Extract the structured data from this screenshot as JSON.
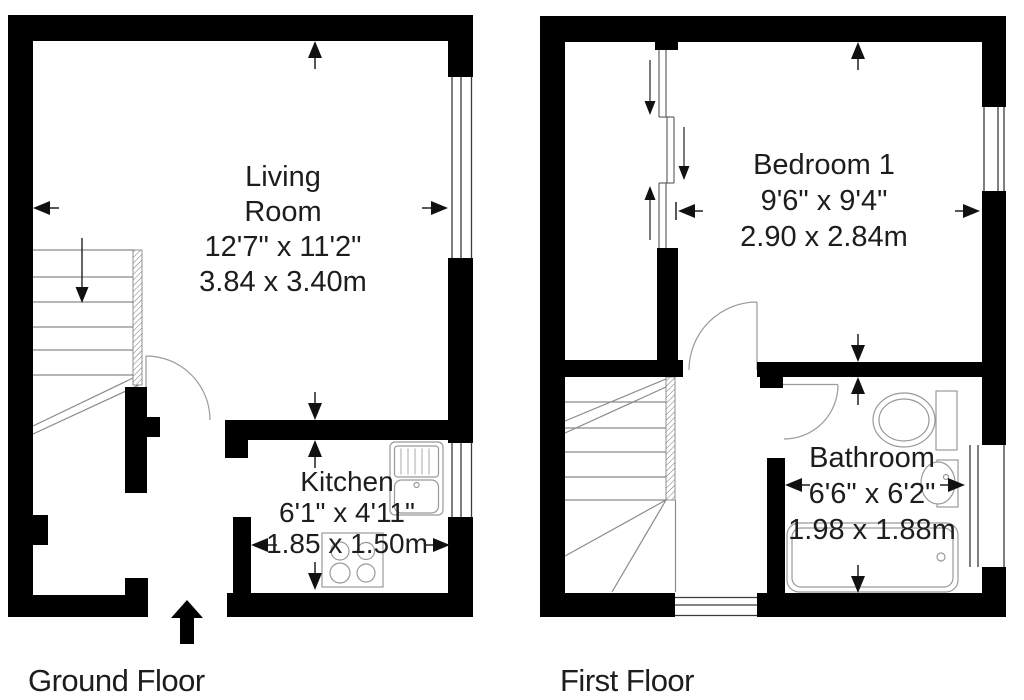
{
  "ground_floor": {
    "floor_label": "Ground Floor",
    "living_room": {
      "lines": [
        "Living",
        "Room",
        "12'7\" x 11'2\"",
        "3.84 x 3.40m"
      ]
    },
    "kitchen": {
      "lines": [
        "Kitchen",
        "6'1\" x 4'11\"",
        "1.85 x 1.50m"
      ]
    }
  },
  "first_floor": {
    "floor_label": "First Floor",
    "bedroom_1": {
      "lines": [
        "Bedroom 1",
        "9'6\" x 9'4\"",
        "2.90 x 2.84m"
      ]
    },
    "bathroom": {
      "lines": [
        "Bathroom",
        "6'6\" x 6'2\"",
        "1.98 x 1.88m"
      ]
    }
  },
  "colors": {
    "wall": "#000000",
    "fixture_line": "#999999",
    "stair_line": "#8a8a8a",
    "window_line": "#3a3a3a",
    "door_line": "#9a9a9a",
    "text": "#1d1d1d",
    "background": "#ffffff"
  }
}
